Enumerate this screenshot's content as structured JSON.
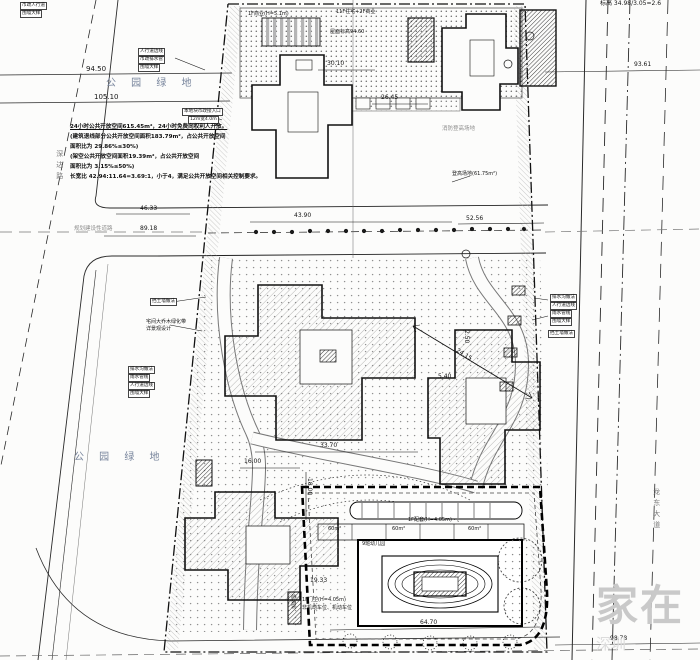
{
  "colors": {
    "ink": "#1a1a1a",
    "secondary_gray": "#8d8d8d",
    "park_label": "#76839b",
    "watermark": "#c9c9c9",
    "paper": "#fcfcfb"
  },
  "watermark": {
    "main": "家在",
    "sub": "深圳"
  },
  "note": {
    "lines": [
      "24小时公共开放空间615.45m²，24小时免费向权利人开放。",
      "(建筑退线部分公共开放空间面积183.79m²，占公共开放空间",
      "面积比为 29.86%≤30%)",
      "(架空公共开放空间面积19.39m²，占公共开放空间",
      "面积比为 3.15%≤50%)",
      "长宽比 42.94:11.64=3.69:1，小于4，满足公共开放空间相关控制要求。"
    ]
  },
  "labels": [
    {
      "name": "dim-94-50",
      "text": "94.50",
      "x": 86,
      "y": 66,
      "cls": "dim"
    },
    {
      "name": "dim-105-10",
      "text": "105.10",
      "x": 94,
      "y": 94,
      "cls": "dim"
    },
    {
      "name": "park-label-top",
      "text": "公 园 绿 地",
      "x": 106,
      "y": 78,
      "cls": "area"
    },
    {
      "name": "park-label-left",
      "text": "公 园 绿 地",
      "x": 74,
      "y": 452,
      "cls": "area"
    },
    {
      "name": "road-name-left",
      "text": "深达路",
      "x": 55,
      "y": 150,
      "cls": "vroad"
    },
    {
      "name": "road-name-right",
      "text": "龙东大道",
      "x": 652,
      "y": 488,
      "cls": "vroad"
    },
    {
      "name": "elev-ratio",
      "text": "标高 34.98/3.05=2.6",
      "x": 600,
      "y": 1,
      "cls": "dim-s"
    },
    {
      "name": "dim-46-33",
      "text": "46.33",
      "x": 140,
      "y": 206,
      "cls": "dim-s"
    },
    {
      "name": "road-type-label",
      "text": "规划建设性道路",
      "x": 74,
      "y": 226,
      "cls": "gray-s"
    },
    {
      "name": "dim-89-18",
      "text": "89.18",
      "x": 140,
      "y": 226,
      "cls": "dim-s"
    },
    {
      "name": "dim-43-90",
      "text": "43.90",
      "x": 294,
      "y": 213,
      "cls": "dim-s"
    },
    {
      "name": "dim-52-56",
      "text": "52.56",
      "x": 466,
      "y": 216,
      "cls": "dim-s"
    },
    {
      "name": "dim-30-10",
      "text": "30.10",
      "x": 327,
      "y": 61,
      "cls": "dim-s"
    },
    {
      "name": "dim-26-45",
      "text": "26.45",
      "x": 381,
      "y": 95,
      "cls": "dim-s"
    },
    {
      "name": "dim-33-70",
      "text": "33.70",
      "x": 320,
      "y": 443,
      "cls": "dim-s"
    },
    {
      "name": "dim-24-15",
      "text": "24.15",
      "x": 458,
      "y": 348,
      "cls": "dim-s",
      "rot": 32
    },
    {
      "name": "dim-2-50",
      "text": "2.50",
      "x": 469,
      "y": 330,
      "cls": "dim-s",
      "rot": 90
    },
    {
      "name": "dim-5-40",
      "text": "5.40",
      "x": 438,
      "y": 374,
      "cls": "dim-s"
    },
    {
      "name": "dim-16-00",
      "text": "16.00",
      "x": 244,
      "y": 459,
      "cls": "dim-s"
    },
    {
      "name": "dim-18-00",
      "text": "18.00",
      "x": 312,
      "y": 478,
      "cls": "dim-s",
      "rot": 90
    },
    {
      "name": "dim-19-33",
      "text": "19.33",
      "x": 310,
      "y": 578,
      "cls": "dim-s"
    },
    {
      "name": "dim-64-70",
      "text": "64.70",
      "x": 420,
      "y": 620,
      "cls": "dim-s"
    },
    {
      "name": "dim-93-61",
      "text": "93.61",
      "x": 634,
      "y": 62,
      "cls": "dim-s"
    },
    {
      "name": "dim-98-78",
      "text": "98.78",
      "x": 610,
      "y": 636,
      "cls": "dim-s"
    },
    {
      "name": "tag-sidewalk-top",
      "text": "人行道边线",
      "x": 138,
      "y": 48,
      "cls": "tag"
    },
    {
      "name": "tag-drain-top",
      "text": "市政排水管",
      "x": 138,
      "y": 56,
      "cls": "tag"
    },
    {
      "name": "tag-wall-top",
      "text": "围墙大样",
      "x": 138,
      "y": 64,
      "cls": "tag"
    },
    {
      "name": "tag-access-1",
      "text": "本地块市政接入口",
      "x": 182,
      "y": 108,
      "cls": "tag"
    },
    {
      "name": "tag-access-2",
      "text": "12m宽4.0m",
      "x": 188,
      "y": 116,
      "cls": "tag"
    },
    {
      "name": "tag-right-1",
      "text": "排水沟做法",
      "x": 550,
      "y": 294,
      "cls": "tag"
    },
    {
      "name": "tag-right-2",
      "text": "人行道边线",
      "x": 550,
      "y": 302,
      "cls": "tag"
    },
    {
      "name": "tag-right-3",
      "text": "雨水管线",
      "x": 550,
      "y": 310,
      "cls": "tag"
    },
    {
      "name": "tag-right-4",
      "text": "围墙大样",
      "x": 550,
      "y": 318,
      "cls": "tag"
    },
    {
      "name": "tag-left-1",
      "text": "排水沟做法",
      "x": 128,
      "y": 366,
      "cls": "tag"
    },
    {
      "name": "tag-left-2",
      "text": "雨水管线",
      "x": 128,
      "y": 374,
      "cls": "tag"
    },
    {
      "name": "tag-left-3",
      "text": "人行道边线",
      "x": 128,
      "y": 382,
      "cls": "tag"
    },
    {
      "name": "tag-left-4",
      "text": "围墙大样",
      "x": 128,
      "y": 390,
      "cls": "tag"
    },
    {
      "name": "retaining-wall-left",
      "text": "挡土墙做法",
      "x": 150,
      "y": 298,
      "cls": "tag"
    },
    {
      "name": "green-belt-1",
      "text": "宅间大乔木绿化带",
      "x": 146,
      "y": 320,
      "cls": "txt-s"
    },
    {
      "name": "green-belt-2",
      "text": "详景观设计",
      "x": 146,
      "y": 327,
      "cls": "txt-s"
    },
    {
      "name": "fire-access-1",
      "text": "消防登高场地",
      "x": 442,
      "y": 126,
      "cls": "gray-s"
    },
    {
      "name": "fire-access-2",
      "text": "登高场地(61.75m²)",
      "x": 452,
      "y": 172,
      "cls": "txt-s"
    },
    {
      "name": "podium-label-1",
      "text": "1F商业(H=5.1m)",
      "x": 248,
      "y": 12,
      "cls": "txt-s"
    },
    {
      "name": "podium-label-2",
      "text": "11F住宅+2F商业",
      "x": 336,
      "y": 10,
      "cls": "txt-s"
    },
    {
      "name": "podium-label-3",
      "text": "屋面标高94.60",
      "x": 330,
      "y": 30,
      "cls": "txt-s"
    },
    {
      "name": "kindergarten-name",
      "text": "9班幼儿园",
      "x": 362,
      "y": 542,
      "cls": "txt-s"
    },
    {
      "name": "kindergarten-annex",
      "text": "1F配套(H=4.05m)",
      "x": 408,
      "y": 518,
      "cls": "txt-s"
    },
    {
      "name": "kindergarten-gate",
      "text": "1F门卫(H=4.05m)",
      "x": 302,
      "y": 598,
      "cls": "txt-s"
    },
    {
      "name": "kindergarten-parking",
      "text": "非机动车位、机动车位",
      "x": 302,
      "y": 606,
      "cls": "txt-s"
    },
    {
      "name": "activity-area-1",
      "text": "60m²",
      "x": 328,
      "y": 527,
      "cls": "txt-s"
    },
    {
      "name": "activity-area-2",
      "text": "60m²",
      "x": 392,
      "y": 527,
      "cls": "txt-s"
    },
    {
      "name": "activity-area-3",
      "text": "60m²",
      "x": 468,
      "y": 527,
      "cls": "txt-s"
    },
    {
      "name": "trash-room",
      "text": "垃圾房",
      "x": 295,
      "y": 594,
      "cls": "txt-s",
      "rot": 90
    },
    {
      "name": "retaining-wall-right",
      "text": "挡土墙做法",
      "x": 548,
      "y": 330,
      "cls": "tag"
    },
    {
      "name": "tag-topleft-1",
      "text": "市政人行道",
      "x": 20,
      "y": 2,
      "cls": "tag"
    },
    {
      "name": "tag-topleft-2",
      "text": "围墙大样",
      "x": 20,
      "y": 10,
      "cls": "tag"
    }
  ]
}
